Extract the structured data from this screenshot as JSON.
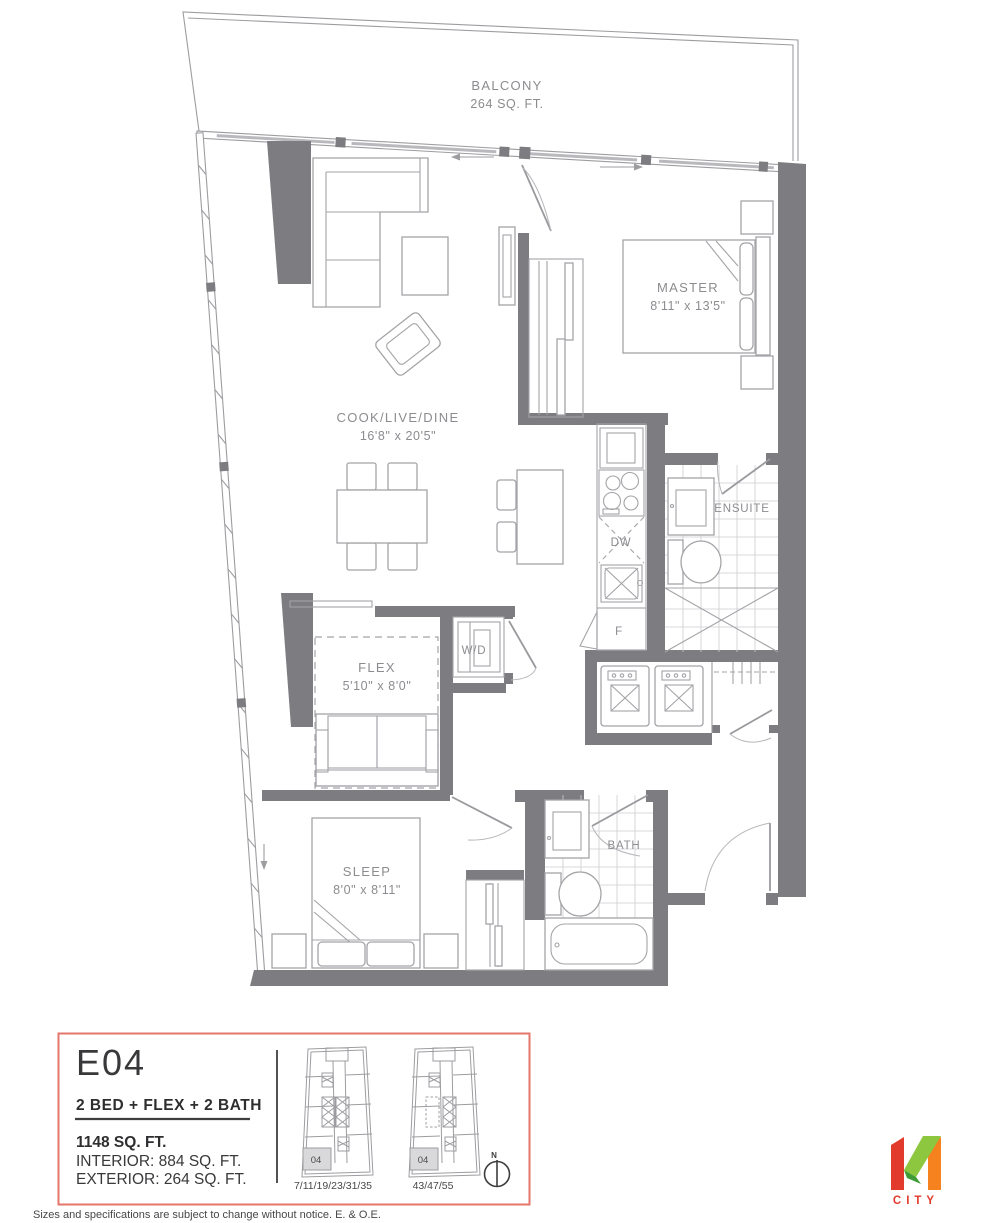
{
  "plan": {
    "balcony": {
      "name": "BALCONY",
      "area": "264 SQ. FT."
    },
    "rooms": {
      "living": {
        "name": "COOK/LIVE/DINE",
        "dims": "16'8\" x 20'5\""
      },
      "master": {
        "name": "MASTER",
        "dims": "8'11\" x 13'5\""
      },
      "ensuite": {
        "name": "ENSUITE"
      },
      "flex": {
        "name": "FLEX",
        "dims": "5'10\" x 8'0\""
      },
      "laundry": {
        "name": "W/D"
      },
      "sleep": {
        "name": "SLEEP",
        "dims": "8'0\" x 8'11\""
      },
      "bath": {
        "name": "BATH"
      }
    },
    "appliances": {
      "dishwasher": "DW",
      "fridge": "F"
    }
  },
  "info": {
    "unit": "E04",
    "layout": "2 BED + FLEX + 2 BATH",
    "total_area": "1148 SQ. FT.",
    "interior": "INTERIOR: 884 SQ. FT.",
    "exterior": "EXTERIOR: 264 SQ. FT."
  },
  "keyplans": [
    {
      "unit": "04",
      "floors": "7/11/19/23/31/35"
    },
    {
      "unit": "04",
      "floors": "43/47/55"
    }
  ],
  "compass": {
    "label": "N"
  },
  "logo": {
    "text": "CITY"
  },
  "disclaimer": "Sizes and specifications are subject to change without notice. E. & O.E.",
  "colors": {
    "accent": "#E5766B",
    "wall": "#7D7D81",
    "logo_red": "#E23A2C",
    "logo_light_green": "#8DC63F",
    "logo_dark_green": "#3F9C35",
    "logo_orange": "#F5821F"
  }
}
